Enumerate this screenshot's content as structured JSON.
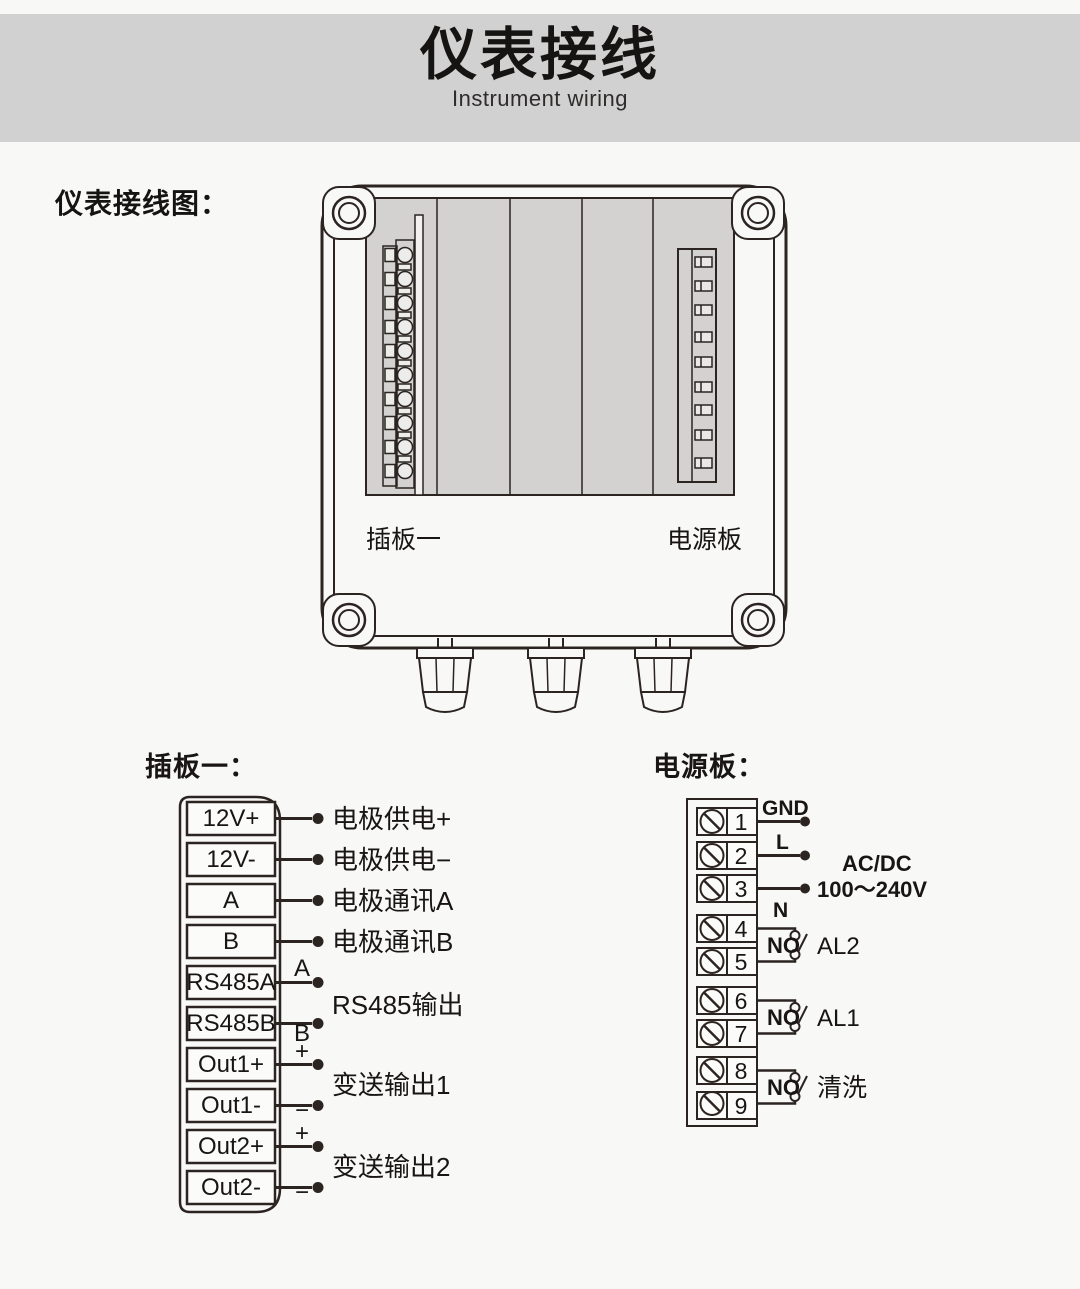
{
  "header": {
    "title": "仪表接线",
    "subtitle": "Instrument wiring"
  },
  "diagram": {
    "caption": "仪表接线图：",
    "slot_left_label": "插板一",
    "slot_right_label": "电源板"
  },
  "plugboard": {
    "title": "插板一：",
    "terminals": [
      "12V+",
      "12V-",
      "A",
      "B",
      "RS485A",
      "RS485B",
      "Out1+",
      "Out1-",
      "Out2+",
      "Out2-"
    ],
    "wire_labels": [
      "电极供电+",
      "电极供电−",
      "电极通讯A",
      "电极通讯B"
    ],
    "rs485_label": "RS485输出",
    "out1_label": "变送输出1",
    "out2_label": "变送输出2",
    "mark_a": "A",
    "mark_b": "B",
    "mark_plus": "+",
    "mark_minus": "−"
  },
  "powerboard": {
    "title": "电源板：",
    "numbers": [
      "1",
      "2",
      "3",
      "4",
      "5",
      "6",
      "7",
      "8",
      "9"
    ],
    "gnd_label": "GND",
    "live_label": "L",
    "neutral_label": "N",
    "supply_line1": "AC/DC",
    "supply_line2": "100～240V",
    "no_label": "NO",
    "relay_labels": [
      "AL2",
      "AL1",
      "清洗"
    ]
  }
}
